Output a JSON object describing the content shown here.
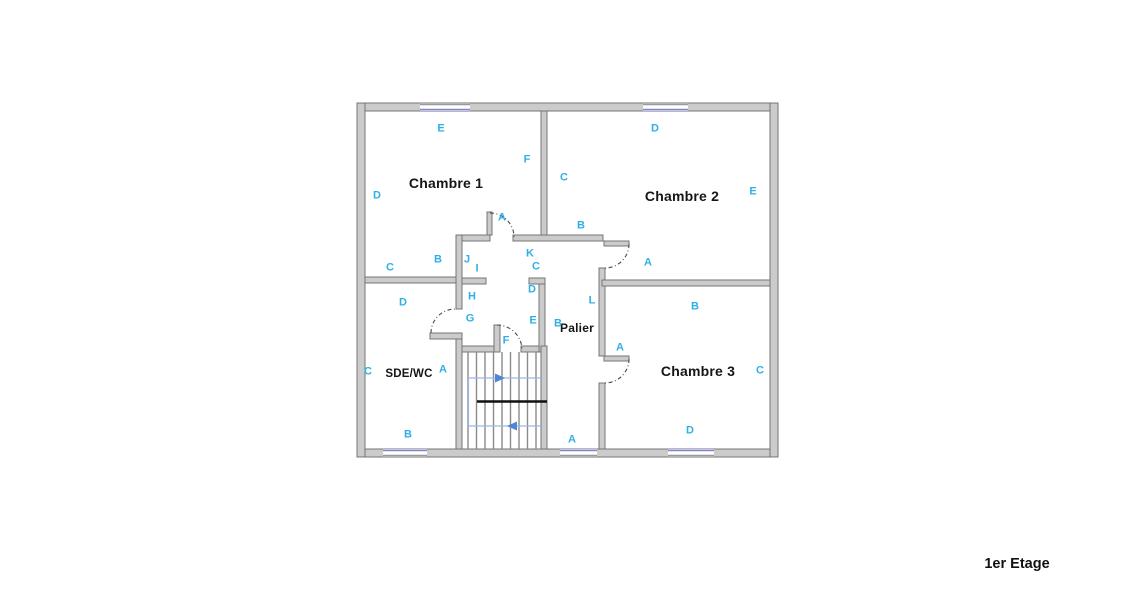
{
  "floor_plan": {
    "floor_label": "1er Etage",
    "colors": {
      "wall_fill": "#cbcbcb",
      "wall_stroke": "#757575",
      "window_blue": "#8585d0",
      "label_cyan": "#2fb0e4",
      "room_text": "#161616",
      "stair_path_blue": "#9cb8e4",
      "stair_arrow_blue": "#4d86d6",
      "door_arc": "#4a4a4a"
    },
    "rooms": {
      "chambre1": {
        "name": "Chambre 1"
      },
      "chambre2": {
        "name": "Chambre 2"
      },
      "chambre3": {
        "name": "Chambre 3"
      },
      "sdewc": {
        "name": "SDE/WC"
      },
      "palier": {
        "name": "Palier"
      }
    },
    "wall_labels": [
      {
        "t": "E",
        "x": 441,
        "y": 129
      },
      {
        "t": "F",
        "x": 527,
        "y": 160
      },
      {
        "t": "D",
        "x": 377,
        "y": 196
      },
      {
        "t": "A",
        "x": 502,
        "y": 218
      },
      {
        "t": "B",
        "x": 438,
        "y": 260
      },
      {
        "t": "C",
        "x": 390,
        "y": 268
      },
      {
        "t": "J",
        "x": 467,
        "y": 260
      },
      {
        "t": "I",
        "x": 477,
        "y": 269
      },
      {
        "t": "K",
        "x": 530,
        "y": 254
      },
      {
        "t": "C",
        "x": 536,
        "y": 267
      },
      {
        "t": "D",
        "x": 532,
        "y": 290
      },
      {
        "t": "H",
        "x": 472,
        "y": 297
      },
      {
        "t": "G",
        "x": 470,
        "y": 319
      },
      {
        "t": "E",
        "x": 533,
        "y": 321
      },
      {
        "t": "F",
        "x": 506,
        "y": 341
      },
      {
        "t": "D",
        "x": 655,
        "y": 129
      },
      {
        "t": "C",
        "x": 564,
        "y": 178
      },
      {
        "t": "E",
        "x": 753,
        "y": 192
      },
      {
        "t": "B",
        "x": 581,
        "y": 226
      },
      {
        "t": "A",
        "x": 648,
        "y": 263
      },
      {
        "t": "L",
        "x": 592,
        "y": 301
      },
      {
        "t": "B",
        "x": 558,
        "y": 324
      },
      {
        "t": "A",
        "x": 620,
        "y": 348
      },
      {
        "t": "A",
        "x": 572,
        "y": 440
      },
      {
        "t": "D",
        "x": 403,
        "y": 303
      },
      {
        "t": "C",
        "x": 368,
        "y": 372
      },
      {
        "t": "A",
        "x": 443,
        "y": 370
      },
      {
        "t": "B",
        "x": 408,
        "y": 435
      },
      {
        "t": "B",
        "x": 695,
        "y": 307
      },
      {
        "t": "C",
        "x": 760,
        "y": 371
      },
      {
        "t": "D",
        "x": 690,
        "y": 431
      }
    ]
  }
}
